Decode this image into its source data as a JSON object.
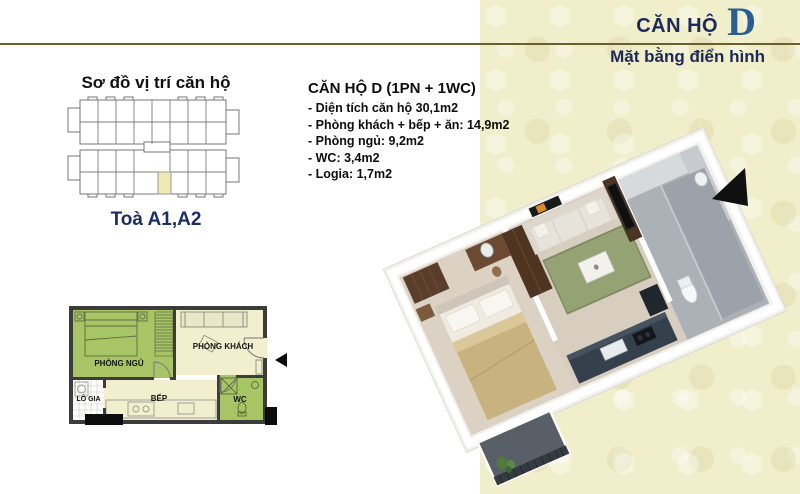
{
  "header": {
    "title_prefix": "CĂN HỘ",
    "title_letter": "D",
    "subtitle": "Mặt bằng điển hình"
  },
  "location_map": {
    "title": "Sơ đồ vị trí căn hộ",
    "tower_label": "Toà A1,A2"
  },
  "specs": {
    "title": "CĂN HỘ D (1PN + 1WC)",
    "items": [
      "- Diện tích căn hộ 30,1m2",
      "- Phòng khách + bếp + ăn: 14,9m2",
      "- Phòng ngủ: 9,2m2",
      "- WC: 3,4m2",
      "- Logia: 1,7m2"
    ]
  },
  "floor_plan_2d": {
    "labels": {
      "bedroom": "PHÒNG NGỦ",
      "living": "PHÒNG KHÁCH",
      "loggia": "LÔ GIA",
      "kitchen": "BẾP",
      "wc": "WC"
    }
  },
  "colors": {
    "accent_gold": "#6b6128",
    "navy": "#1b2a58",
    "letter_blue": "#2a5e92",
    "cream_background": "#f0eecb",
    "room_green": "#a7c565",
    "room_cream": "#f2efcf",
    "wall_dark": "#3c3c3a",
    "unit_highlight": "#f0e9b2"
  }
}
